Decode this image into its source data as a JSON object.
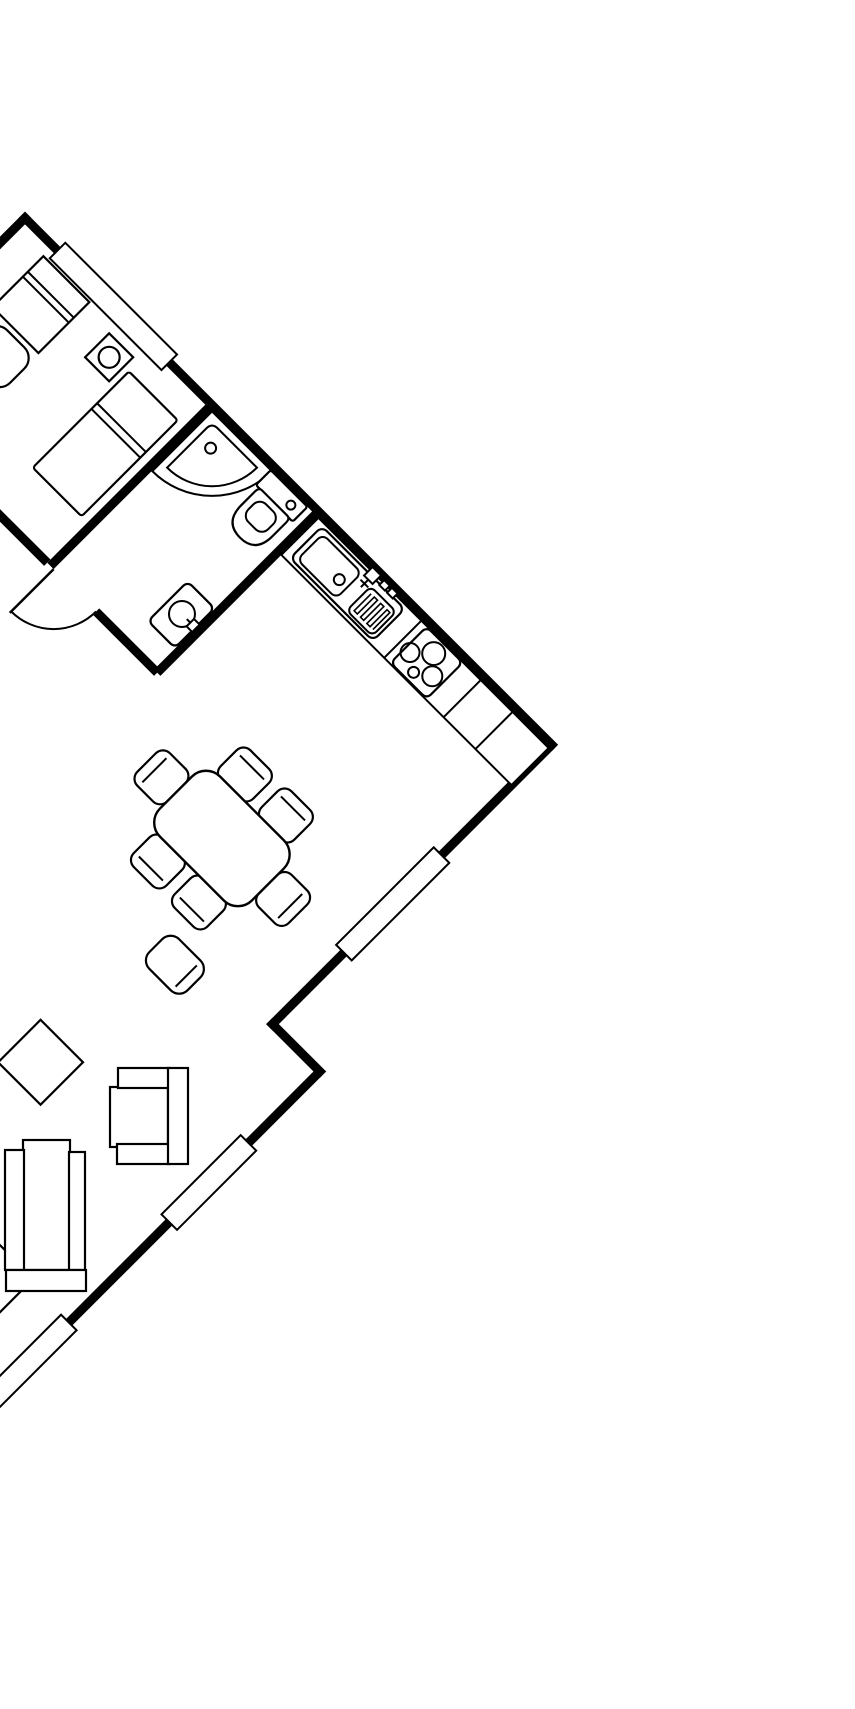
{
  "canvas": {
    "width_px": 855,
    "height_px": 1709,
    "background_color": "#ffffff",
    "line_color": "#000000",
    "plan_rotation_deg": 45,
    "text_labels": []
  },
  "plan": {
    "type": "apartment-floor-plan",
    "window_count": 4,
    "door_count": 1,
    "rooms": [
      {
        "name": "bedroom",
        "items": [
          {
            "icon": "bed-icon"
          },
          {
            "icon": "pillow-break-lines-icon"
          },
          {
            "icon": "nightstand-icon"
          },
          {
            "icon": "table-lamp-icon"
          },
          {
            "icon": "wardrobe-icon"
          },
          {
            "icon": "bedroom-chair-icon"
          },
          {
            "icon": "window-icon"
          }
        ]
      },
      {
        "name": "bathroom",
        "items": [
          {
            "icon": "corner-shower-icon"
          },
          {
            "icon": "shower-drain-icon"
          },
          {
            "icon": "toilet-icon"
          },
          {
            "icon": "washbasin-icon"
          },
          {
            "icon": "door-swing-icon"
          }
        ]
      },
      {
        "name": "kitchen",
        "items": [
          {
            "icon": "kitchen-counter-icon"
          },
          {
            "icon": "kitchen-sink-icon"
          },
          {
            "icon": "faucet-icon"
          },
          {
            "icon": "dish-drainer-icon"
          },
          {
            "icon": "cooktop-icon"
          },
          {
            "icon": "burner-icon",
            "count": 4
          }
        ]
      },
      {
        "name": "living-dining",
        "items": [
          {
            "icon": "dining-table-icon"
          },
          {
            "icon": "dining-chair-icon",
            "count": 6
          },
          {
            "icon": "lounge-chair-icon"
          },
          {
            "icon": "armchair-icon"
          },
          {
            "icon": "sofa-icon"
          },
          {
            "icon": "square-side-table-icon",
            "count": 2
          },
          {
            "icon": "window-icon",
            "count": 3
          }
        ]
      }
    ]
  }
}
